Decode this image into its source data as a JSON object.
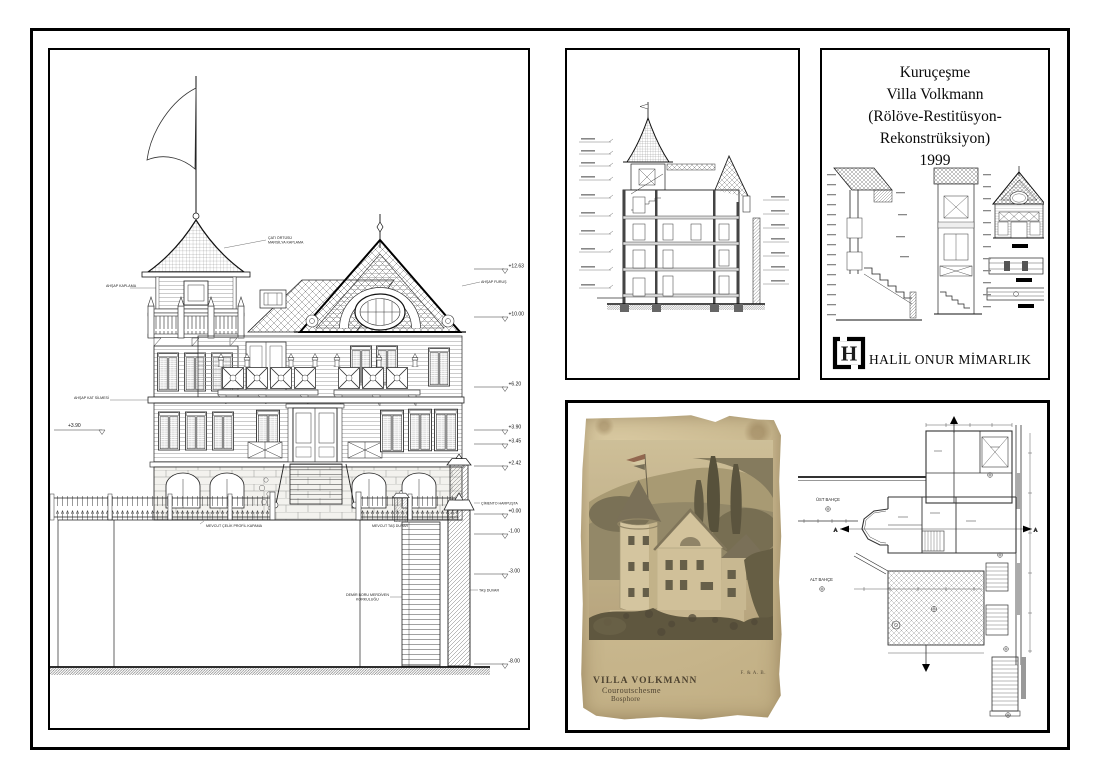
{
  "page": {
    "background": "#ffffff",
    "frame_color": "#000000"
  },
  "title_block": {
    "lines": [
      "Kuruçeşme",
      "Villa Volkmann",
      "(Rölöve-Restitüsyon-",
      "Rekonstrüksiyon)",
      "1999"
    ],
    "firm_name": "HALİL ONUR MİMARLIK",
    "logo_letter": "H"
  },
  "elevation": {
    "levels_right": [
      "+12.63",
      "+10.00",
      "+6.20",
      "+3.90",
      "+3.45",
      "+2.42",
      "+0.00",
      "-1.00",
      "-3.00",
      "-8.00"
    ],
    "level_left": "+3.90",
    "annotations": {
      "roof_1": "ÇATI ÖRTÜSÜ",
      "roof_2": "MARSİLYA KAPLAMA",
      "siding": "AHŞAP KAPLAMA",
      "floor_trim": "AHŞAP KAT SİLMESİ",
      "bracket": "AHŞAP FURUŞ",
      "gate_wall": "MEVCUT ÇELİK PROFİL KAPAMA",
      "existing_wall": "MEVCUT TAŞ DUVAR",
      "coping": "ÇİMENTO HARPUŞTA",
      "stone_pier": "TAŞ DUVAR",
      "stair_rail_1": "DEMİR BORU MERDİVEN",
      "stair_rail_2": "KORKULUĞU"
    }
  },
  "plan": {
    "upper_garden": "ÜST BAHÇE",
    "lower_garden": "ALT BAHÇE",
    "section_letter": "A"
  },
  "photo": {
    "caption_title": "VILLA VOLKMANN",
    "caption_location": "Couroutschesme",
    "caption_region": "Bosphore",
    "caption_credit": "F. & A. B."
  }
}
